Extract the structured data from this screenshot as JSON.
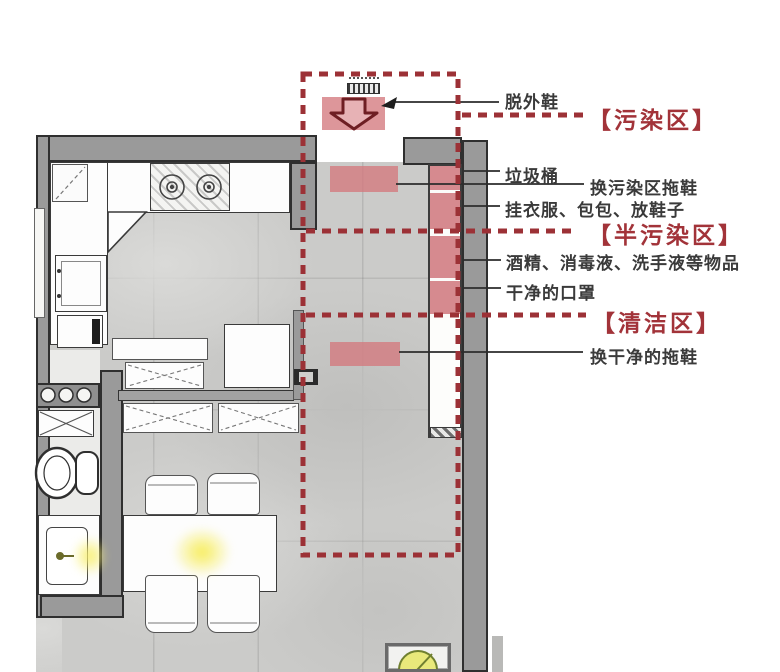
{
  "diagram": {
    "type": "apartment-entry-floorplan",
    "zones": [
      {
        "id": "contaminated",
        "label": "【污染区】"
      },
      {
        "id": "semi_contaminated",
        "label": "【半污染区】"
      },
      {
        "id": "clean",
        "label": "【清洁区】"
      }
    ],
    "annotations": [
      {
        "id": "take_off_outdoor_shoes",
        "label": "脱外鞋"
      },
      {
        "id": "trash_bin",
        "label": "垃圾桶"
      },
      {
        "id": "change_contaminated_zone_slippers",
        "label": "换污染区拖鞋"
      },
      {
        "id": "hang_clothes_bags_place_shoes",
        "label": "挂衣服、包包、放鞋子"
      },
      {
        "id": "alcohol_disinfectant_hand_sanitizer_items",
        "label": "酒精、消毒液、洗手液等物品"
      },
      {
        "id": "clean_masks",
        "label": "干净的口罩"
      },
      {
        "id": "change_clean_slippers",
        "label": "换干净的拖鞋"
      }
    ],
    "colors": {
      "zone_dash_red": "#9c3136",
      "zone_label_red": "#a23339",
      "mat_pink": "#d68a8f",
      "wall_gray": "#9a9a9a",
      "floor_gray": "#cbcbc9",
      "leader_black": "#2c2c2c",
      "glow_yellow": "#f4ea5e"
    }
  }
}
